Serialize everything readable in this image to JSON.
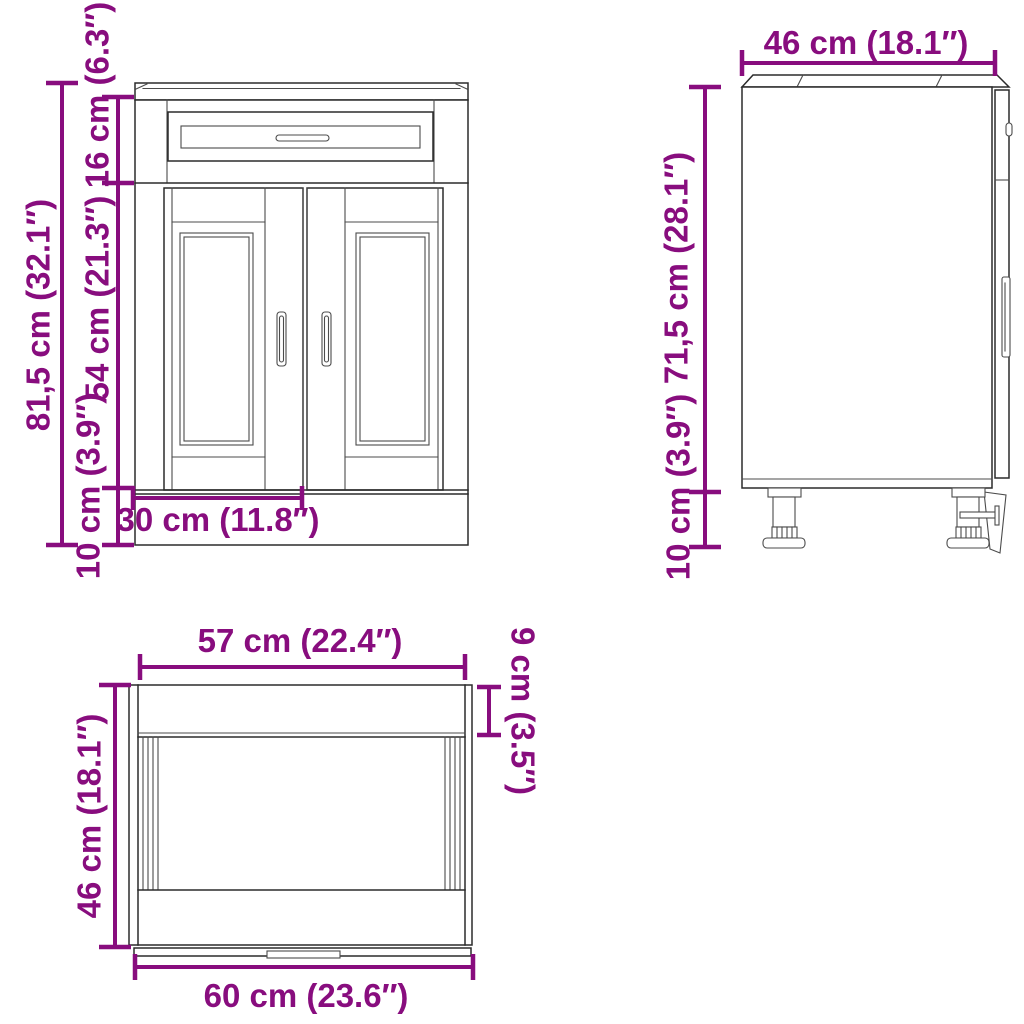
{
  "style": {
    "dimension_color": "#880D7E",
    "line_color": "#2b2b2b",
    "background": "#ffffff"
  },
  "views": {
    "front": {
      "labels": {
        "total_height": "81,5 cm (32.1″)",
        "drawer_section_height": "16 cm (6.3″)",
        "door_height": "54 cm (21.3″)",
        "plinth_height": "10 cm (3.9″)",
        "door_width": "30 cm (11.8″)"
      }
    },
    "side": {
      "labels": {
        "depth": "46 cm (18.1″)",
        "body_height": "71,5 cm (28.1″)",
        "leg_height": "10 cm (3.9″)"
      }
    },
    "top": {
      "labels": {
        "inner_width": "57 cm (22.4″)",
        "front_rail_depth": "9 cm (3.5″)",
        "depth": "46 cm (18.1″)",
        "total_width": "60 cm (23.6″)"
      }
    }
  }
}
